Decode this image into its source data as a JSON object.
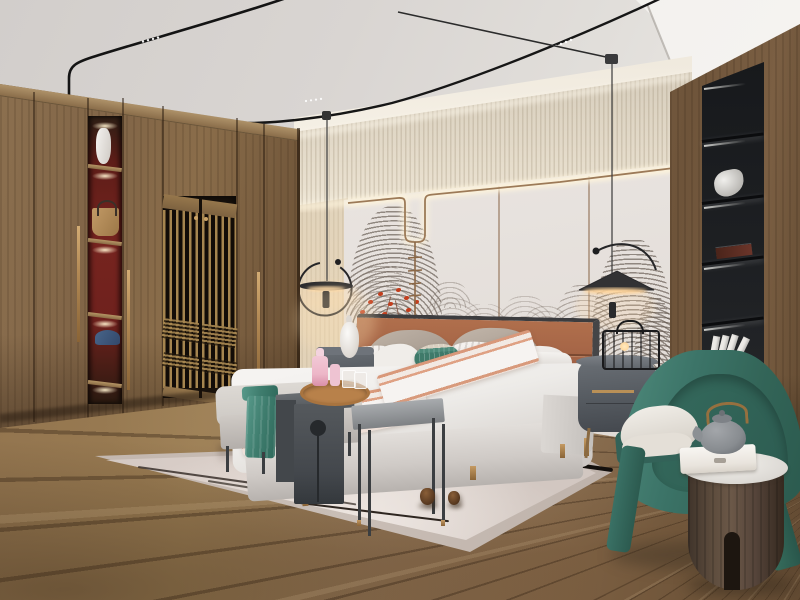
{
  "scene": {
    "description": "Photorealistic rendering of a modern Chinese (Japandi) style bedroom",
    "objects": [
      "wood-wardrobe-wall",
      "lattice-sliding-doors",
      "display-niche-with-vase-handbag-cap",
      "ceiling-track-lights",
      "pendant-lamps",
      "textured-wallpaper-band",
      "wave-mural-accent-wall",
      "red-coral-branch",
      "upholstered-bed",
      "striped-and-teal-pillows",
      "peach-striped-throw",
      "foot-bench-with-teal-runner",
      "dark-waterfall-side-table",
      "wood-tray-with-pink-decanter",
      "square-stool-table",
      "left-nightstand-with-ceramic-lamp",
      "right-nightstand-with-wire-lantern",
      "black-built-in-shelf",
      "teal-barrel-armchair",
      "drum-side-table-with-teapot-and-box",
      "area-rug-with-branch-pattern",
      "pine-cones",
      "plank-wood-floor"
    ]
  },
  "palette": {
    "ceiling": "#d8d4d1",
    "band": "#d8cfbf",
    "panel": "#e9e4e0",
    "flower": "#c23e1e",
    "wood": "#8a6d4a",
    "lattice": "#a5854f",
    "niche-red": "#76241f",
    "shelf": "#1f2124",
    "floor": "#9b7d53",
    "rug": "#c9beb6",
    "rug-field": "#ddd2cc",
    "duvet": "#edebe8",
    "headboard": "#a26245",
    "peach": "#d9987a",
    "teal": "#3f7d6e",
    "bench": "#cbc7c2",
    "saddle": "#43474c",
    "stool": "#8f9295",
    "nightstand": "#565b61",
    "brass": "#b38a55",
    "chair": "#3c7468",
    "chair-dark": "#2d5c51",
    "cushion": "#dcd7cf",
    "drum": "#6b5848",
    "marble": "#dcd9d4",
    "teapot": "#888c90",
    "glow": "#ffddab",
    "pink": "#edb7c8",
    "track": "#141414"
  }
}
